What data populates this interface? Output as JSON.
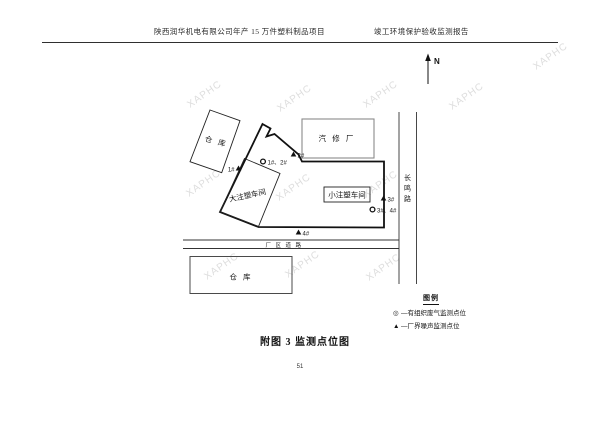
{
  "header": {
    "title_left": "陕西润华机电有限公司年产 15 万件塑料制品项目",
    "title_right": "竣工环境保护验收监测报告"
  },
  "watermark": {
    "text": "XAPHC"
  },
  "north_label": "N",
  "diagram": {
    "buildings": {
      "warehouse_top": "仓  库",
      "auto_repair_plant": "汽 修 厂",
      "large_injection_workshop": "大注塑车间",
      "small_injection_workshop": "小注塑车间",
      "warehouse_bottom": "仓  库"
    },
    "roads": {
      "changming_chars": [
        "长",
        "鸣",
        "路"
      ],
      "factory_road": "厂 区 道 路"
    },
    "markers": {
      "noise_1": "1#",
      "noise_2": "2#",
      "noise_3": "3#",
      "noise_4": "4#",
      "gas_12": "1#、2#",
      "gas_34": "3#、4#"
    }
  },
  "legend": {
    "title": "图例",
    "items": [
      {
        "symbol": "◎",
        "label": "—有组织废气监测点位"
      },
      {
        "symbol": "▲",
        "label": "—厂界噪声监测点位"
      }
    ]
  },
  "caption": "附图 3 监测点位图",
  "page_number": "51",
  "colors": {
    "line": "#1a1a1a",
    "light_border": "#8a8a8a",
    "watermark": "#bdbdbd"
  }
}
